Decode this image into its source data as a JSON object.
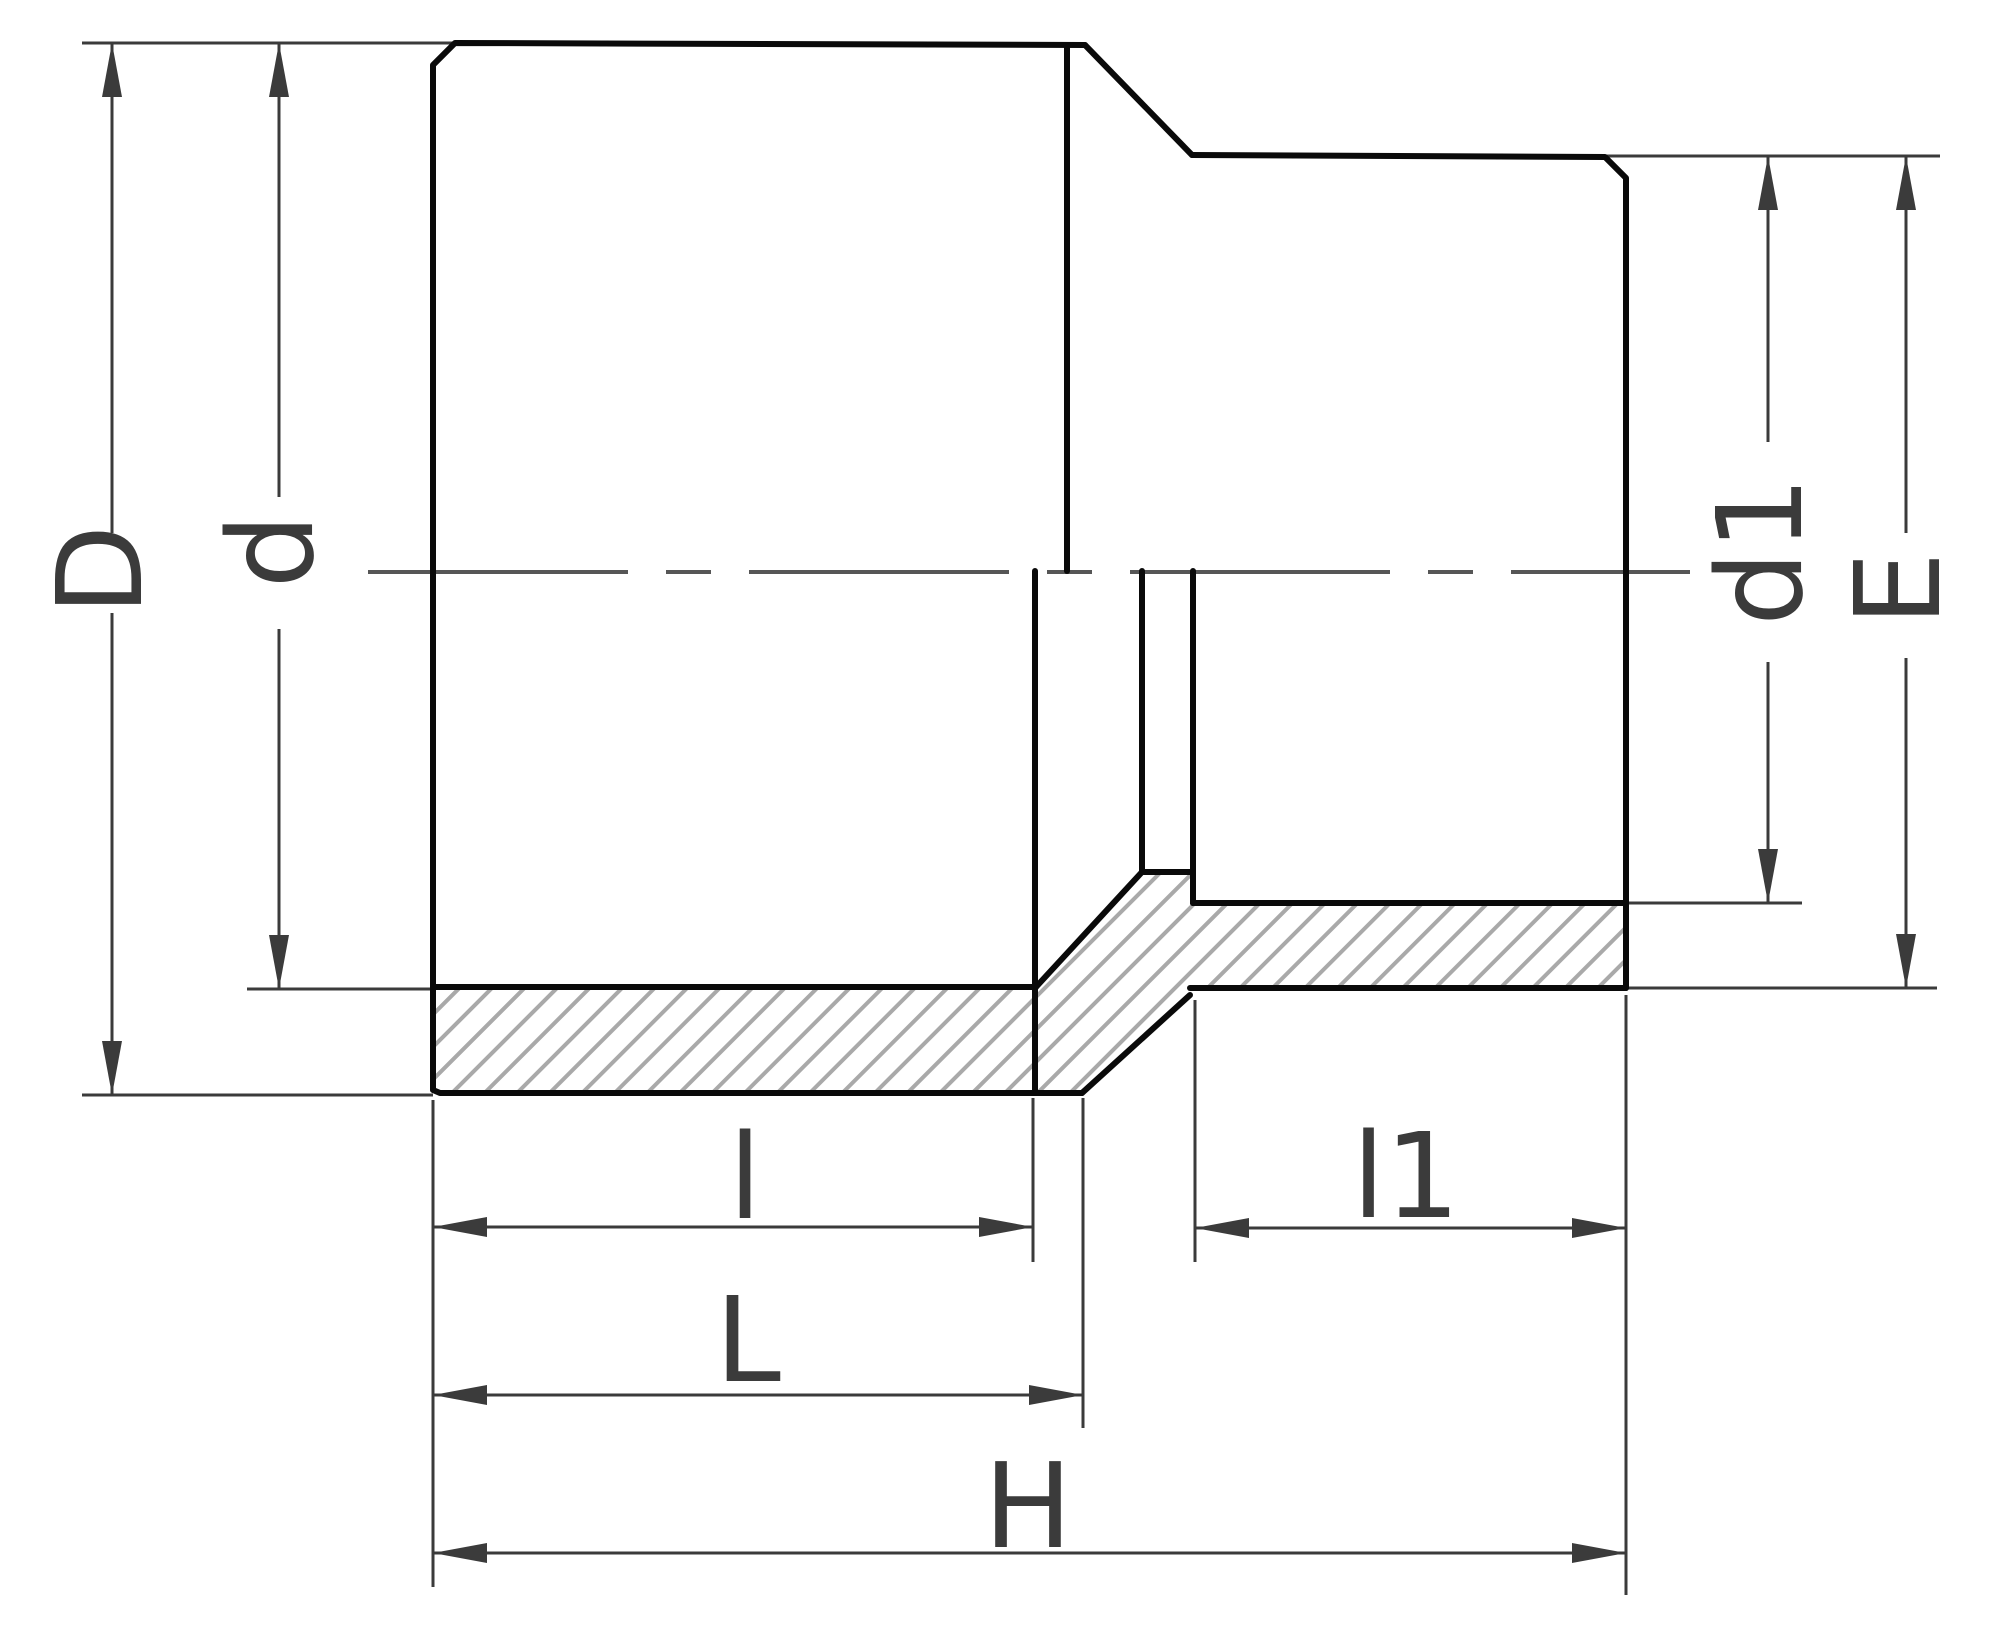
{
  "canvas": {
    "width": 2000,
    "height": 1647,
    "background": "#ffffff"
  },
  "colors": {
    "body_line": "#0a0a0a",
    "dimension_line": "#3b3b3b",
    "label_text": "#3b3b3b",
    "hatch_line": "#a9a9a9",
    "centerline": "#565656"
  },
  "centerline": {
    "x1": 368,
    "y1": 572,
    "x2": 1690,
    "y2": 572,
    "width": 4,
    "dash": "260 38 45 38"
  },
  "hatch": {
    "spacing": 23,
    "line_width": 4,
    "angle": -45
  },
  "hatch_region": {
    "points": [
      [
        433,
        987
      ],
      [
        1036,
        987
      ],
      [
        1142,
        872
      ],
      [
        1193,
        872
      ],
      [
        1193,
        903
      ],
      [
        1626,
        903
      ],
      [
        1626,
        988
      ],
      [
        1190,
        988
      ],
      [
        1082,
        1093
      ],
      [
        433,
        1093
      ]
    ]
  },
  "body_lines": [
    {
      "name": "outer-left-profile",
      "points": [
        [
          1085,
          45
        ],
        [
          455,
          43
        ],
        [
          433,
          65
        ],
        [
          433,
          1090
        ],
        [
          440,
          1093
        ],
        [
          1082,
          1093
        ]
      ],
      "width": 6
    },
    {
      "name": "outer-chamfer",
      "points": [
        [
          1085,
          45
        ],
        [
          1192,
          155
        ]
      ],
      "width": 6
    },
    {
      "name": "outer-right-profile",
      "points": [
        [
          1192,
          155
        ],
        [
          1605,
          157
        ],
        [
          1626,
          178
        ],
        [
          1626,
          988
        ]
      ],
      "width": 6
    },
    {
      "name": "lower-transition-cone",
      "points": [
        [
          1082,
          1093
        ],
        [
          1190,
          995
        ]
      ],
      "width": 6
    },
    {
      "name": "right-outer-bottom",
      "points": [
        [
          1190,
          988
        ],
        [
          1626,
          988
        ]
      ],
      "width": 6
    },
    {
      "name": "left-socket-bore-wall",
      "points": [
        [
          433,
          987
        ],
        [
          1036,
          987
        ]
      ],
      "width": 6
    },
    {
      "name": "upper-transition-cone",
      "points": [
        [
          1036,
          987
        ],
        [
          1142,
          872
        ]
      ],
      "width": 6
    },
    {
      "name": "channel-bore-wall",
      "points": [
        [
          1142,
          872
        ],
        [
          1193,
          872
        ],
        [
          1193,
          903
        ]
      ],
      "width": 6
    },
    {
      "name": "right-socket-bore-wall",
      "points": [
        [
          1193,
          903
        ],
        [
          1626,
          903
        ]
      ],
      "width": 6
    },
    {
      "name": "left-socket-end-edge",
      "points": [
        [
          1035,
          571
        ],
        [
          1035,
          1093
        ]
      ],
      "width": 6
    },
    {
      "name": "channel-wall-left-edge",
      "points": [
        [
          1142,
          571
        ],
        [
          1142,
          872
        ]
      ],
      "width": 6
    },
    {
      "name": "channel-wall-right-edge",
      "points": [
        [
          1193,
          571
        ],
        [
          1193,
          903
        ]
      ],
      "width": 6
    },
    {
      "name": "outer-step-edge-upper",
      "points": [
        [
          1067,
          45
        ],
        [
          1067,
          571
        ]
      ],
      "width": 6
    }
  ],
  "extension_lines": [
    {
      "name": "ext-top-left",
      "x1": 82,
      "y1": 43,
      "x2": 455,
      "y2": 43
    },
    {
      "name": "ext-d-bottom",
      "x1": 247,
      "y1": 989,
      "x2": 433,
      "y2": 989
    },
    {
      "name": "ext-D-bottom",
      "x1": 82,
      "y1": 1095,
      "x2": 433,
      "y2": 1095
    },
    {
      "name": "ext-top-right",
      "x1": 1605,
      "y1": 156,
      "x2": 1940,
      "y2": 156
    },
    {
      "name": "ext-d1-bottom",
      "x1": 1626,
      "y1": 903,
      "x2": 1802,
      "y2": 903
    },
    {
      "name": "ext-E-bottom",
      "x1": 1626,
      "y1": 988,
      "x2": 1937,
      "y2": 988
    },
    {
      "name": "ext-left-face",
      "x1": 433,
      "y1": 1100,
      "x2": 433,
      "y2": 1587
    },
    {
      "name": "ext-socket-depth",
      "x1": 1033,
      "y1": 1098,
      "x2": 1033,
      "y2": 1262
    },
    {
      "name": "ext-left-body-end",
      "x1": 1083,
      "y1": 1098,
      "x2": 1083,
      "y2": 1428
    },
    {
      "name": "ext-right-socket-end",
      "x1": 1195,
      "y1": 1000,
      "x2": 1195,
      "y2": 1262
    },
    {
      "name": "ext-right-face",
      "x1": 1626,
      "y1": 995,
      "x2": 1626,
      "y2": 1595
    }
  ],
  "dimensions": [
    {
      "label": "D",
      "orientation": "vertical",
      "axis_pos": 112,
      "start": 43,
      "end": 1095,
      "segments": [
        [
          43,
          533
        ],
        [
          613,
          1095
        ]
      ],
      "label_x": 100,
      "label_y": 570,
      "label_rotated": true
    },
    {
      "label": "d",
      "orientation": "vertical",
      "axis_pos": 279,
      "start": 43,
      "end": 989,
      "segments": [
        [
          43,
          497
        ],
        [
          629,
          989
        ]
      ],
      "label_x": 271,
      "label_y": 551,
      "label_rotated": true
    },
    {
      "label": "d1",
      "orientation": "vertical",
      "axis_pos": 1768,
      "start": 156,
      "end": 903,
      "segments": [
        [
          156,
          442
        ],
        [
          662,
          903
        ]
      ],
      "label_x": 1760,
      "label_y": 551,
      "label_rotated": true
    },
    {
      "label": "E",
      "orientation": "vertical",
      "axis_pos": 1906,
      "start": 156,
      "end": 988,
      "segments": [
        [
          156,
          533
        ],
        [
          658,
          988
        ]
      ],
      "label_x": 1898,
      "label_y": 589,
      "label_rotated": true
    },
    {
      "label": "l",
      "orientation": "horizontal",
      "axis_pos": 1227,
      "start": 433,
      "end": 1033,
      "segments": [
        [
          433,
          1033
        ]
      ],
      "label_x": 745,
      "label_y": 1177,
      "label_rotated": false
    },
    {
      "label": "L",
      "orientation": "horizontal",
      "axis_pos": 1395,
      "start": 433,
      "end": 1083,
      "segments": [
        [
          433,
          1083
        ]
      ],
      "label_x": 748,
      "label_y": 1340,
      "label_rotated": false
    },
    {
      "label": "l1",
      "orientation": "horizontal",
      "axis_pos": 1228,
      "start": 1195,
      "end": 1626,
      "segments": [
        [
          1195,
          1626
        ]
      ],
      "label_x": 1406,
      "label_y": 1176,
      "label_rotated": false
    },
    {
      "label": "H",
      "orientation": "horizontal",
      "axis_pos": 1553,
      "start": 433,
      "end": 1626,
      "segments": [
        [
          433,
          1626
        ]
      ],
      "label_x": 1028,
      "label_y": 1506,
      "label_rotated": false
    }
  ],
  "arrow": {
    "length": 54,
    "half_width": 10
  },
  "line_widths": {
    "dimension": 3,
    "extension": 3
  }
}
